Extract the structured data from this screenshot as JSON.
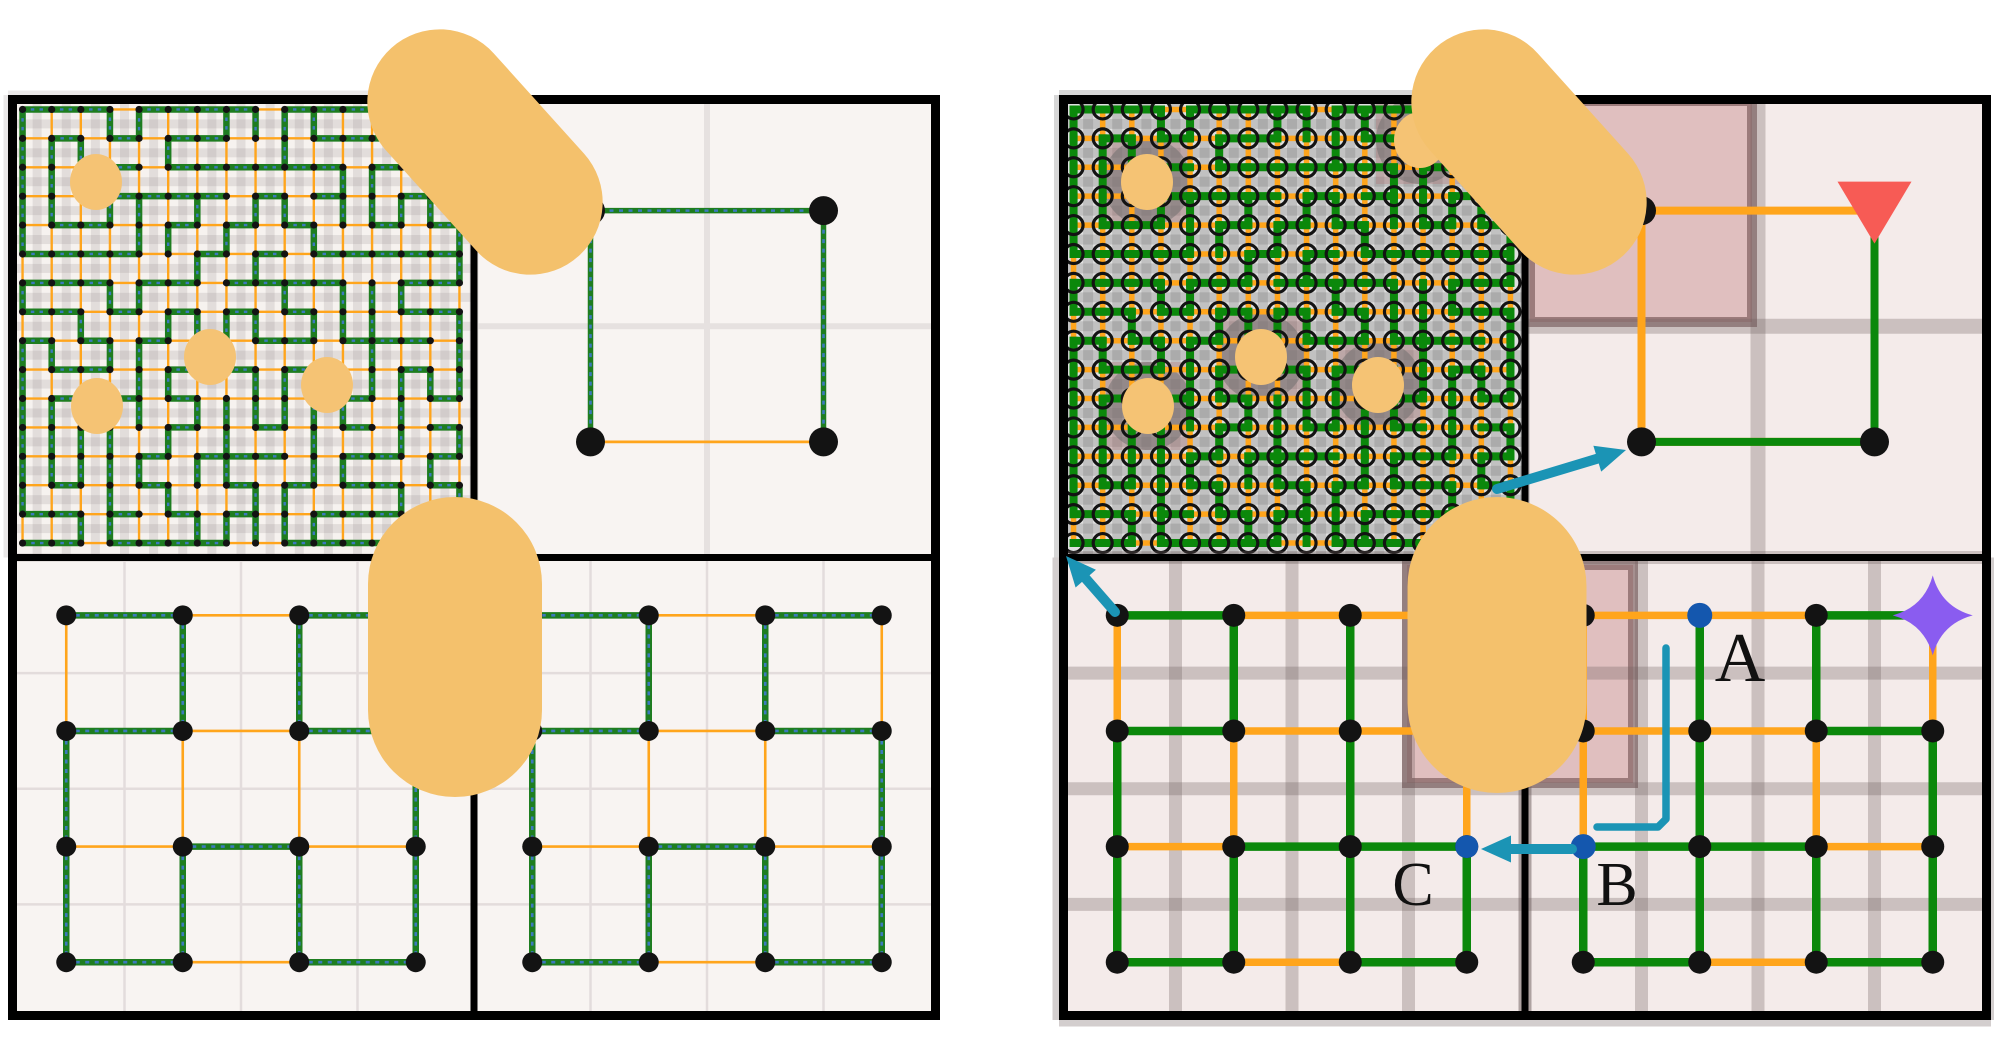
{
  "figure_type": "hierarchical-maze-planning-diagram",
  "colors": {
    "background": "#ffffff",
    "panel_border": "#000000",
    "left_bg": "#f8f4f2",
    "right_bg": "#f4ebea",
    "dense_bg_left": "#f6f2ef",
    "dense_bg_right": "#e0e0e0",
    "plaid_left": "rgba(150,140,140,0.20)",
    "plaid_right": "rgba(122,122,122,0.30)",
    "grid_thin": "#e3dcdc",
    "grid_mid": "#e6e1e0",
    "grid_thick": "rgba(110,92,92,0.30)",
    "orange_edge": "#FFA51C",
    "green_edge_left": "#1e7d20",
    "green_edge_right": "#0b880b",
    "dash_blue": "#3b79bd",
    "node_black": "#131313",
    "capsule": "#f4c16c",
    "obstacle": "#f5c374",
    "halo_gray": "rgba(108,108,108,0.50)",
    "maroon_fill": "rgba(195,130,130,0.42)",
    "maroon_stroke": "rgba(100,68,68,0.55)",
    "teal": "#1b94b5",
    "goal_red": "#f75b55",
    "star_purple": "#8a5cf0",
    "waypoint_blue": "#1457ae",
    "label_color": "#111111"
  },
  "labels": {
    "waypoint_a": "A",
    "waypoint_b": "B",
    "waypoint_c": "C"
  },
  "label_layout": {
    "a": {
      "x": 1740,
      "y": 681,
      "size": 70
    },
    "b": {
      "x": 1617,
      "y": 905,
      "size": 62
    },
    "c": {
      "x": 1413,
      "y": 905,
      "size": 62
    }
  },
  "dense_maze": {
    "rows": 16,
    "cols": 16,
    "seed": 1337
  },
  "obstacles_left": [
    [
      88,
      87
    ],
    [
      202,
      262
    ],
    [
      319,
      290
    ],
    [
      89,
      311
    ]
  ],
  "obstacles_right": [
    [
      88,
      87
    ],
    [
      202,
      262
    ],
    [
      319,
      290
    ],
    [
      89,
      311
    ],
    [
      361,
      45
    ]
  ],
  "coarse_mazes": {
    "left_bl": {
      "h": [
        "GOG",
        "GOG",
        "OGO",
        "GOG"
      ],
      "v": [
        "OGGO",
        "GOOG",
        "GGGG"
      ]
    },
    "left_br": {
      "h": [
        "GOG",
        "GOG",
        "OGO",
        "GOG"
      ],
      "v": [
        "OGGO",
        "GOOG",
        "GGGG"
      ]
    },
    "right_bl": {
      "h": [
        "GOO",
        "GOO",
        "OGG",
        "GOG"
      ],
      "v": [
        "OGGO",
        "GOGO",
        "GGGG"
      ]
    },
    "right_br": {
      "h": [
        "OOG",
        "OOG",
        "GGO",
        "GOG"
      ],
      "v": [
        "OGGO",
        "OGOG",
        "GGGG"
      ]
    }
  },
  "top_right_quadrants": {
    "left": {
      "green": [
        "top",
        "left",
        "right"
      ],
      "dots": [
        "tl",
        "tr",
        "bl",
        "br"
      ],
      "shaded_cell": false
    },
    "right": {
      "green": [
        "bottom",
        "right"
      ],
      "dots": [
        "tl",
        "bl",
        "br"
      ],
      "shaded_cell": true
    }
  },
  "markers": {
    "goal_triangle": {
      "panel": "right",
      "quad": "tr",
      "node": [
        1,
        0
      ]
    },
    "star": {
      "panel": "right",
      "quad": "br",
      "node": [
        3,
        0
      ]
    },
    "waypoint_a": {
      "panel": "right",
      "quad": "br",
      "node": [
        1,
        0
      ]
    },
    "waypoint_b": {
      "panel": "right",
      "quad": "br",
      "node": [
        0,
        2
      ]
    },
    "waypoint_c": {
      "panel": "right",
      "quad": "bl",
      "node": [
        3,
        2
      ]
    }
  },
  "capsules": [
    {
      "id": "left-top",
      "cx": 485,
      "cy": 152,
      "w": 145,
      "h": 280,
      "angle": -42
    },
    {
      "id": "left-mid",
      "cx": 455,
      "cy": 647,
      "w": 174,
      "h": 300,
      "angle": 0
    },
    {
      "id": "right-top",
      "cx": 1529,
      "cy": 152,
      "w": 145,
      "h": 280,
      "angle": -42
    },
    {
      "id": "right-mid",
      "cx": 1497,
      "cy": 645,
      "w": 179,
      "h": 296,
      "angle": 0
    }
  ],
  "maroon_regions": [
    {
      "id": "tr-blocked-cell",
      "x": 1525,
      "y": 96,
      "w": 232,
      "h": 231
    },
    {
      "id": "mid-blocked-strip",
      "x": 1402,
      "y": 560,
      "w": 236,
      "h": 228
    }
  ],
  "arrows": [
    {
      "name": "arrow-to-start-dot",
      "from": [
        1497,
        489
      ],
      "to": [
        1626,
        450
      ],
      "head": true,
      "width": 10
    },
    {
      "name": "arrow-to-fine-maze",
      "from": [
        1115,
        612
      ],
      "to": [
        1066,
        556
      ],
      "head": true,
      "width": 10
    },
    {
      "name": "arrow-b-to-c",
      "from": [
        1572,
        849
      ],
      "to": [
        1481,
        849
      ],
      "head": true,
      "width": 10
    },
    {
      "name": "path-a-to-b",
      "points": [
        [
          1666,
          648
        ],
        [
          1666,
          819
        ],
        [
          1658,
          827
        ],
        [
          1597,
          827
        ]
      ],
      "head": false,
      "width": 7.5
    }
  ]
}
